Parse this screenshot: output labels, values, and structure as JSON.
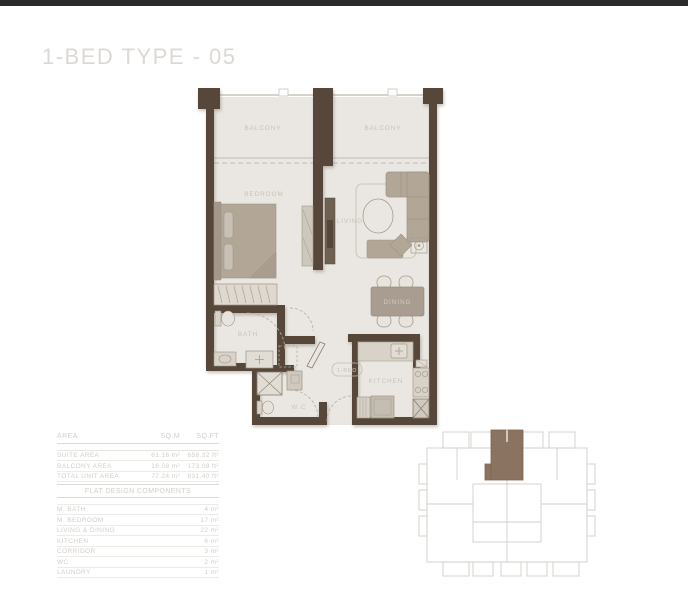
{
  "page": {
    "title": "1-BED TYPE - 05"
  },
  "plan": {
    "balcony_left": "BALCONY",
    "balcony_right": "BALCONY",
    "bedroom": "BEDROOM",
    "living": "LIVING",
    "dining": "DINING",
    "kitchen": "KITCHEN",
    "bath": "BATH",
    "wc": "W.C",
    "unit_tag": "1-BED"
  },
  "area_table": {
    "headers": {
      "area": "AREA",
      "sqm": "SQ.M",
      "sqft": "SQ.FT"
    },
    "rows": [
      {
        "label": "SUITE AREA",
        "sqm": "61.16 m²",
        "sqft": "658.32 ft²"
      },
      {
        "label": "BALCONY AREA",
        "sqm": "16.08 m²",
        "sqft": "173.08 ft²"
      },
      {
        "label": "TOTAL UNIT AREA",
        "sqm": "77.24 m²",
        "sqft": "831.40 ft²"
      }
    ]
  },
  "components_table": {
    "title": "FLAT DESIGN COMPONENTS",
    "rows": [
      {
        "label": "M. BATH",
        "value": "4 m²"
      },
      {
        "label": "M. BEDROOM",
        "value": "17 m²"
      },
      {
        "label": "LIVING & DINING",
        "value": "22 m²"
      },
      {
        "label": "KITCHEN",
        "value": "6 m²"
      },
      {
        "label": "CORRIDOR",
        "value": "3 m²"
      },
      {
        "label": "WC",
        "value": "2 m²"
      },
      {
        "label": "LAUNDRY",
        "value": "1 m²"
      }
    ]
  },
  "colors": {
    "top_bar": "#2b2b2b",
    "wall": "#57473a",
    "floor": "#eae7e2",
    "furniture": "#b2a797",
    "label_text": "#c6c2bb",
    "table_text": "#d2cfc9",
    "keyplan_outline": "#d2cfc8",
    "keyplan_highlight": "#8a7360"
  }
}
